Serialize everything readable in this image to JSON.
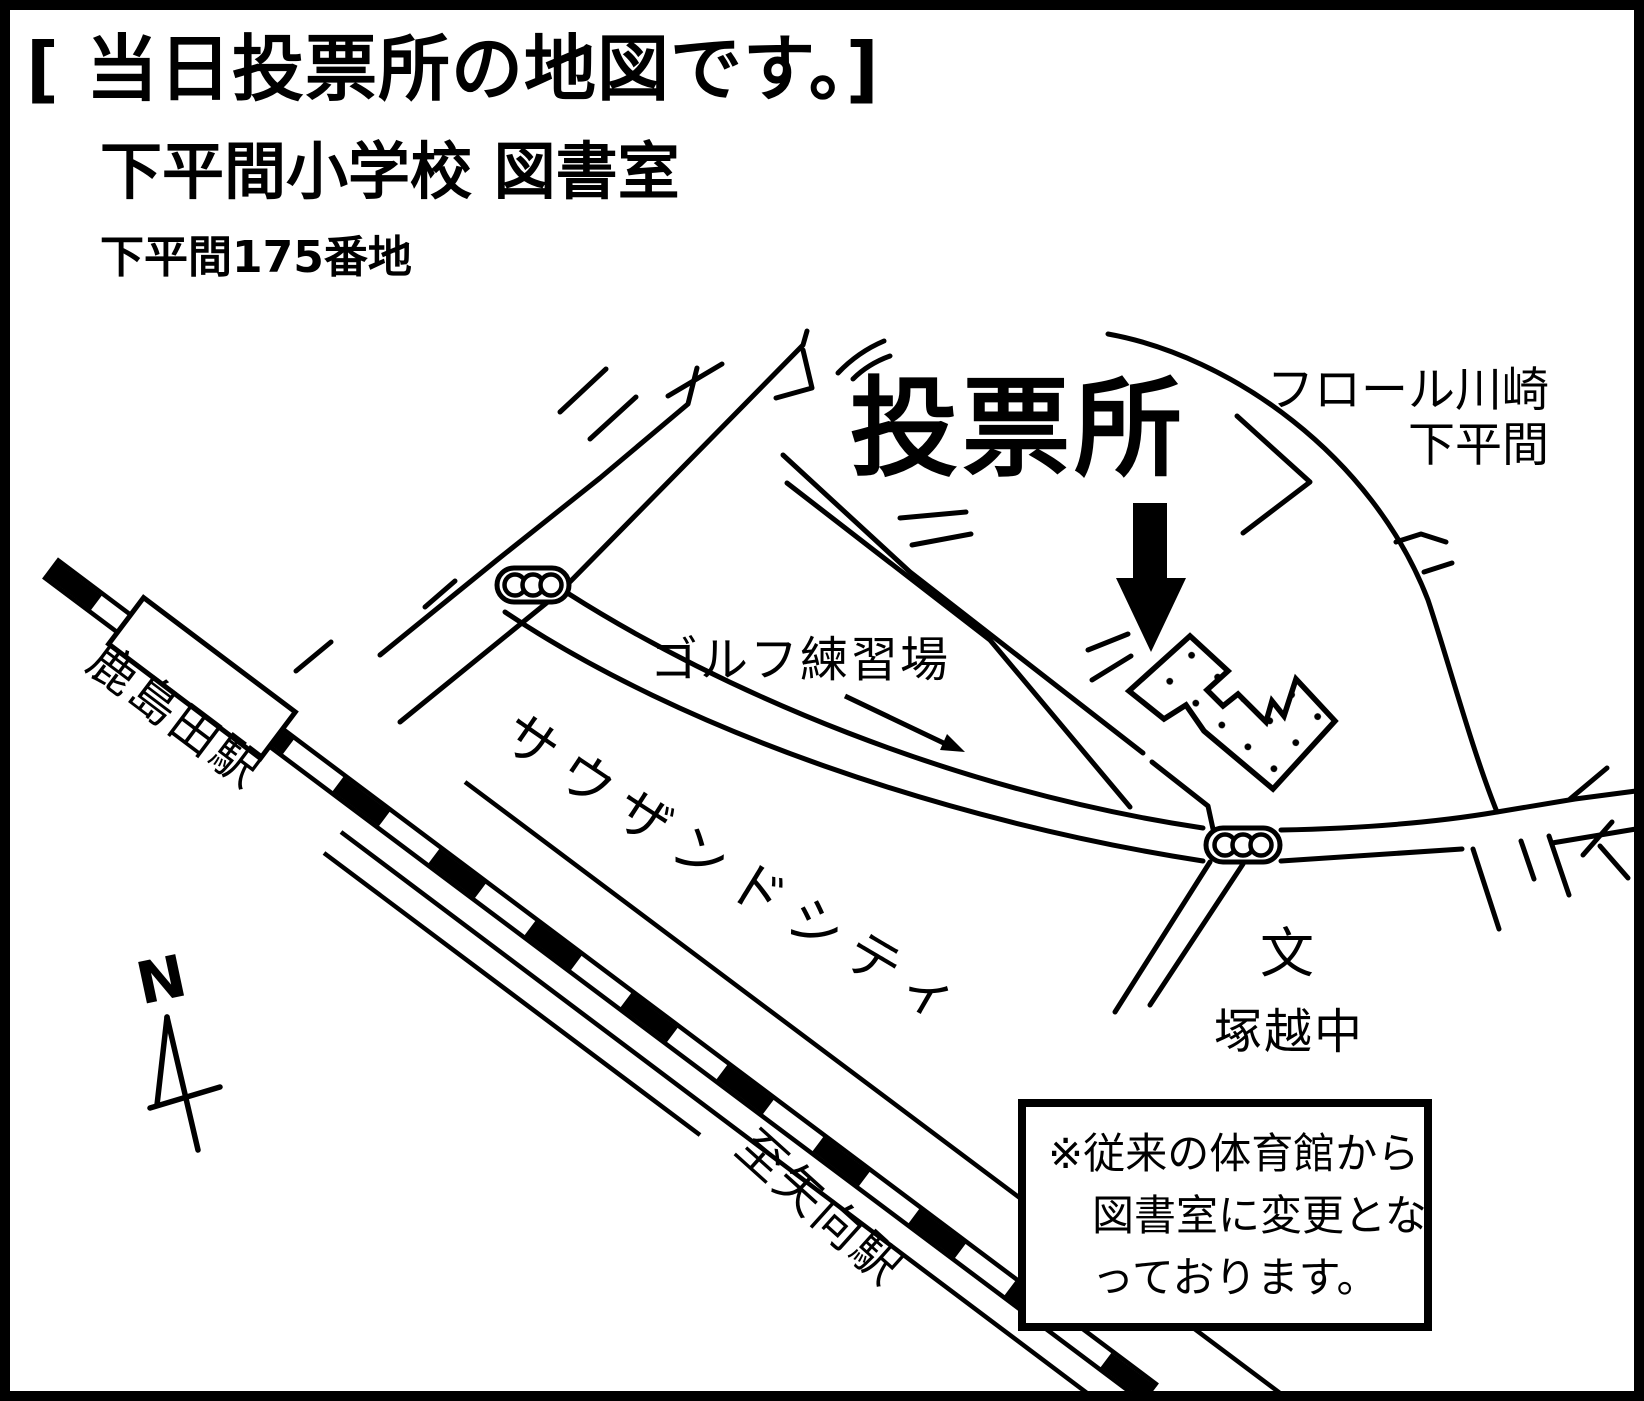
{
  "title": {
    "line1": "[ 当日投票所の地図です。]",
    "line2": "下平間小学校 図書室",
    "line3": "下平間175番地"
  },
  "labels": {
    "polling_place": "投票所",
    "flor_kawasaki_line1": "フロール川崎",
    "flor_kawasaki_line2": "下平間",
    "golf_range": "ゴルフ練習場",
    "thousand_city": "サウザンドシティ",
    "kashimada_station": "鹿島田駅",
    "to_yako_station": "至矢向駅",
    "school_mark": "文",
    "tsukagoshi_jhs": "塚越中",
    "compass_north": "N"
  },
  "note": {
    "line1": "※従来の体育館から",
    "line2": "図書室に変更とな",
    "line3": "っております。"
  },
  "colors": {
    "ink": "#000000",
    "paper": "#ffffff"
  }
}
